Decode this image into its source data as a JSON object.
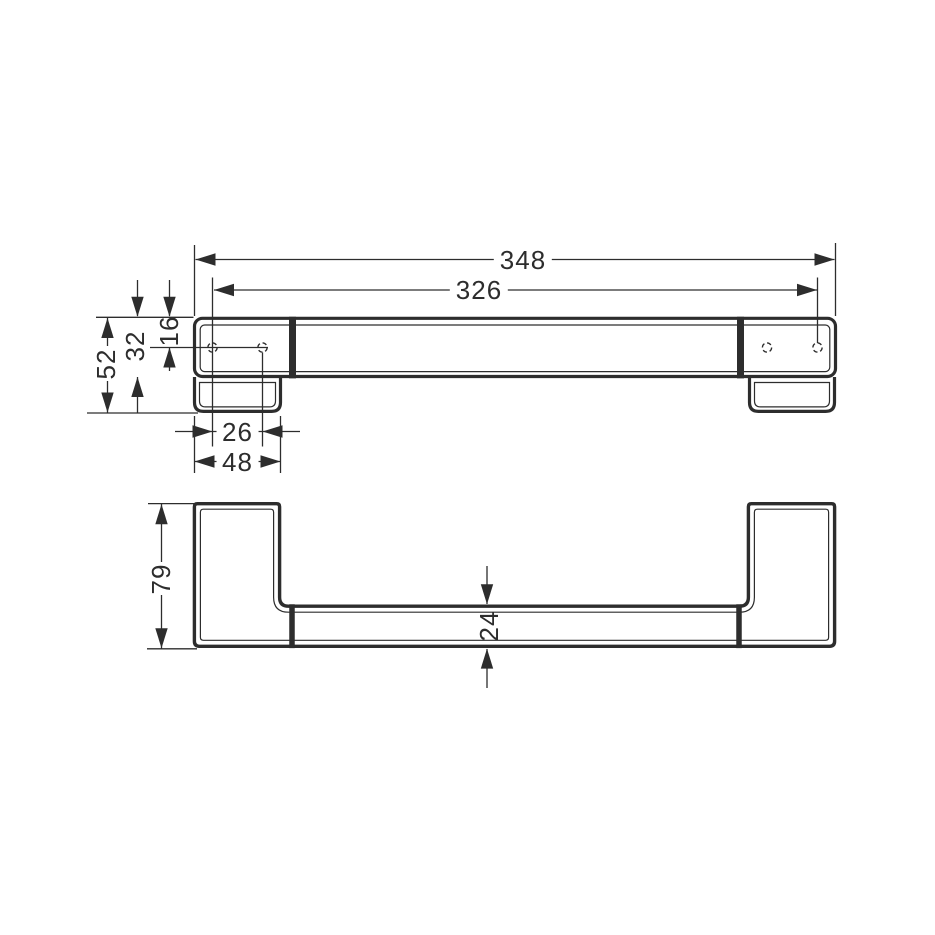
{
  "drawing": {
    "type": "technical-dimension-drawing",
    "views": {
      "plan_view": "top view of wall bar with two end plates and mounting holes",
      "front_view": "front elevation of bar with two end posts"
    }
  },
  "dimensions": {
    "overall_width": "348",
    "mounting_hole_spacing": "326",
    "top_edge_to_hole": "16",
    "rail_depth": "32",
    "overall_depth": "52",
    "plate_hole_spacing": "26",
    "plate_width": "48",
    "overall_height": "79",
    "rail_height": "24"
  },
  "colors": {
    "line": "#2d2d2d",
    "background": "#ffffff"
  }
}
